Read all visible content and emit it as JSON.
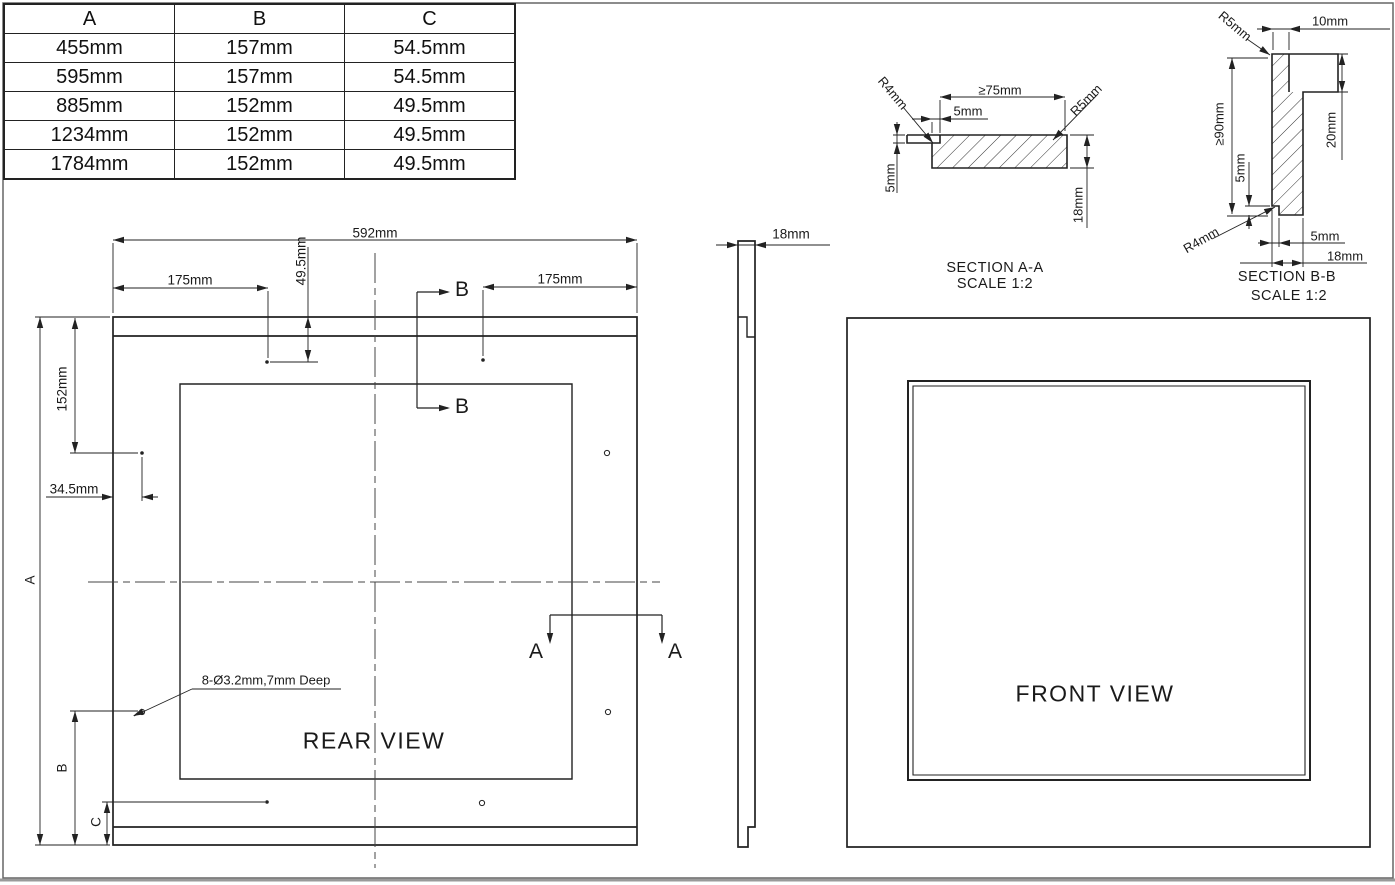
{
  "table": {
    "headers": [
      "A",
      "B",
      "C"
    ],
    "rows": [
      [
        "455mm",
        "157mm",
        "54.5mm"
      ],
      [
        "595mm",
        "157mm",
        "54.5mm"
      ],
      [
        "885mm",
        "152mm",
        "49.5mm"
      ],
      [
        "1234mm",
        "152mm",
        "49.5mm"
      ],
      [
        "1784mm",
        "152mm",
        "49.5mm"
      ]
    ]
  },
  "rear_view": {
    "title": "REAR VIEW",
    "dims": {
      "overall_width": "592mm",
      "hole_from_left": "175mm",
      "hole_from_right": "175mm",
      "hole_row_offset": "49.5mm",
      "side_hole_offset": "152mm",
      "edge_offset": "34.5mm",
      "height_ref": "A",
      "b_ref": "B",
      "c_ref": "C",
      "holes_note": "8-Ø3.2mm,7mm Deep"
    },
    "section_marks": {
      "a": "A",
      "b": "B"
    }
  },
  "side_view": {
    "thickness": "18mm"
  },
  "front_view": {
    "title": "FRONT VIEW"
  },
  "section_aa": {
    "title": "SECTION A-A",
    "scale": "SCALE 1:2",
    "dims": {
      "min_width": "≥75mm",
      "lip_inset": "5mm",
      "lip_thickness": "5mm",
      "thickness": "18mm",
      "radius_left": "R4mm",
      "radius_right": "R5mm"
    }
  },
  "section_bb": {
    "title": "SECTION B-B",
    "scale": "SCALE 1:2",
    "dims": {
      "top_width": "10mm",
      "radius_top": "R5mm",
      "min_height": "≥90mm",
      "step_height": "5mm",
      "tab_height": "20mm",
      "step_width": "5mm",
      "thickness": "18mm",
      "radius_bottom": "R4mm"
    }
  }
}
